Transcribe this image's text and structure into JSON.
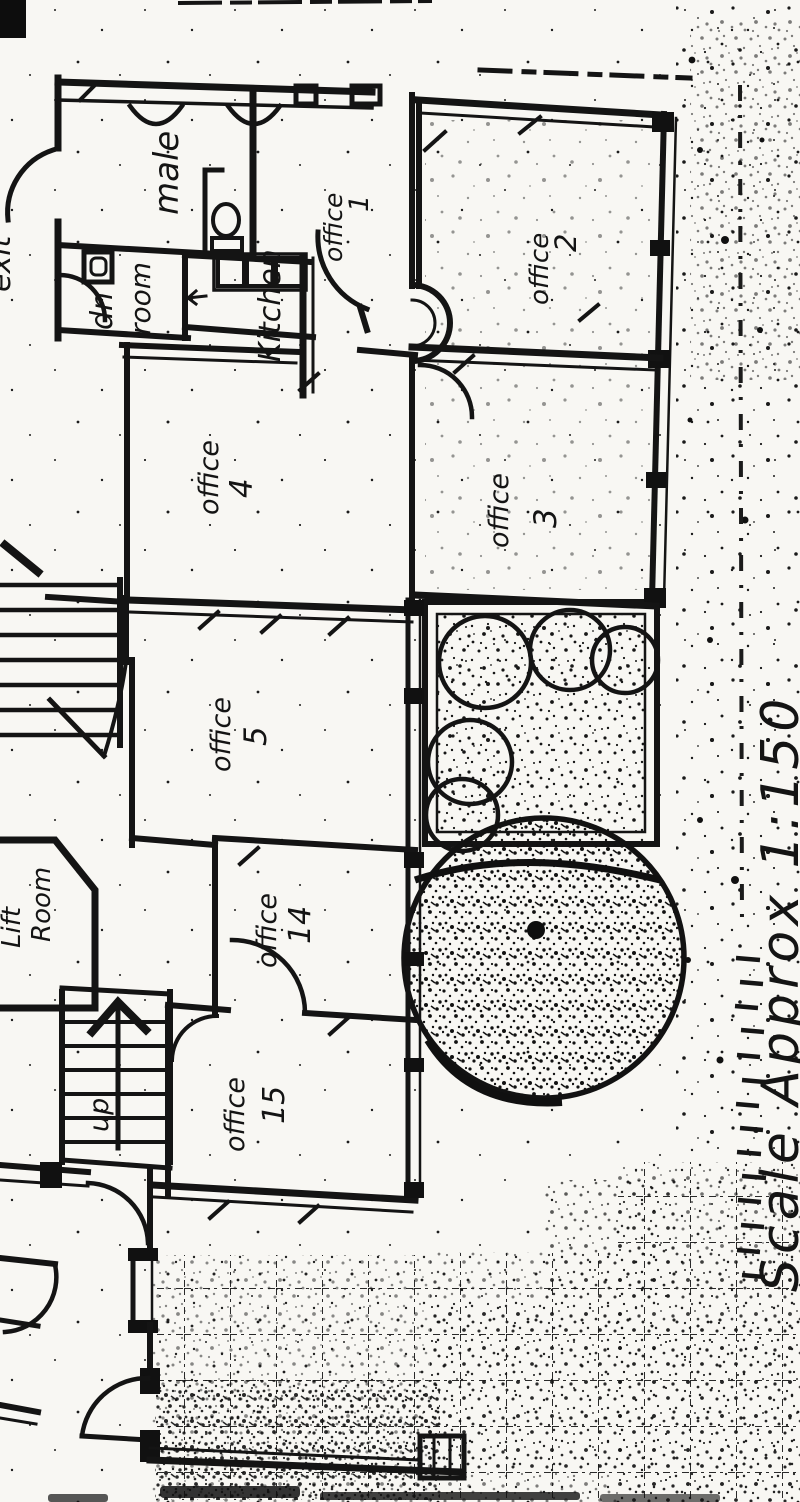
{
  "document": {
    "kind": "scanned hand-drawn floor plan",
    "colors": {
      "ink": "#161616",
      "paper": "#f8f7f3"
    }
  },
  "plan": {
    "rooms": {
      "male": {
        "label": "male"
      },
      "cleaner": {
        "line1": "dn",
        "line2": "room"
      },
      "kitchen": {
        "label": "Kitchen"
      },
      "office1": {
        "word": "office",
        "num": "1"
      },
      "office2": {
        "word": "office",
        "num": "2"
      },
      "office3": {
        "word": "office",
        "num": "3"
      },
      "office4": {
        "word": "office",
        "num": "4"
      },
      "office5": {
        "word": "office",
        "num": "5"
      },
      "office14": {
        "word": "office",
        "num": "14"
      },
      "office15": {
        "word": "office",
        "num": "15"
      },
      "lift_room": {
        "line1": "Lift",
        "line2": "Room"
      }
    },
    "annotations": {
      "up": "up",
      "exit": "exit",
      "scale_note": "Scale Approx 1:150"
    }
  }
}
